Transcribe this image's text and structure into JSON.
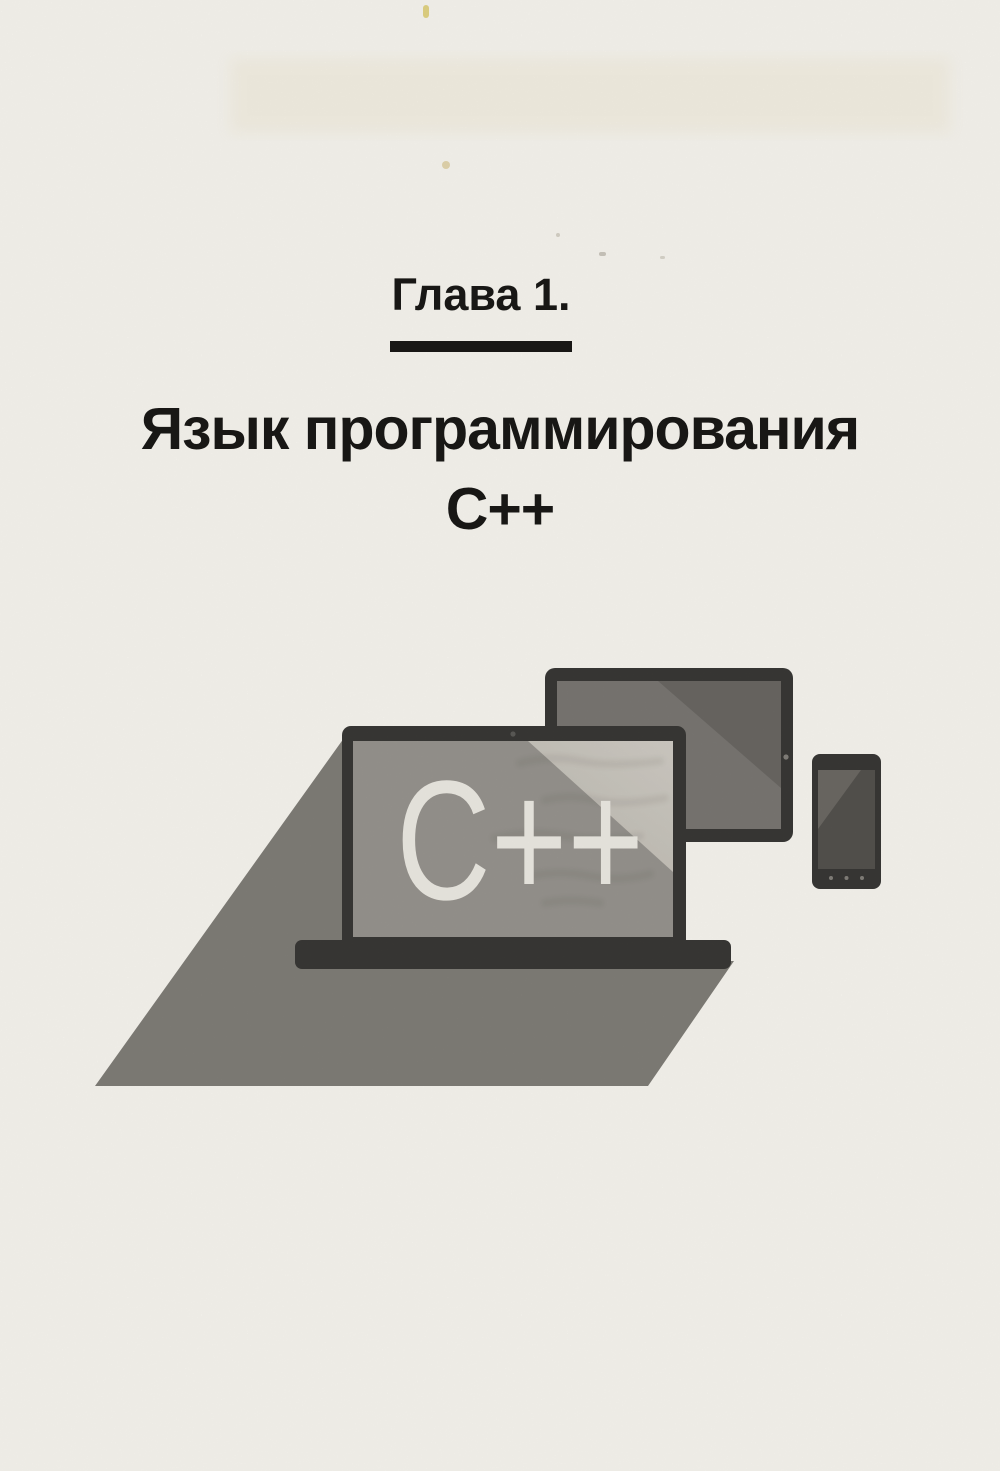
{
  "page": {
    "paper_color": "#fbf9f3",
    "ink_color": "#1a1917"
  },
  "header": {
    "chapter_label": "Глава 1.",
    "title_line1": "Язык программирования",
    "title_line2": "C++"
  },
  "illustration": {
    "screen_text": "C++",
    "colors": {
      "bezel": "#3a3936",
      "laptop_screen": "#999690",
      "screen_highlight": "#d3cfc7",
      "screen_highlight_deep": "#c2beb6",
      "tablet_screen": "#7b7874",
      "tablet_screen_dark": "#6b6864",
      "phone_screen": "#55534f",
      "phone_screen_highlight": "#6d6a65",
      "shadow": "#827f79",
      "screen_text_color": "#f0ede6",
      "camera_dot": "#85827c",
      "laptop_camera_dot": "#5d5c58"
    }
  }
}
